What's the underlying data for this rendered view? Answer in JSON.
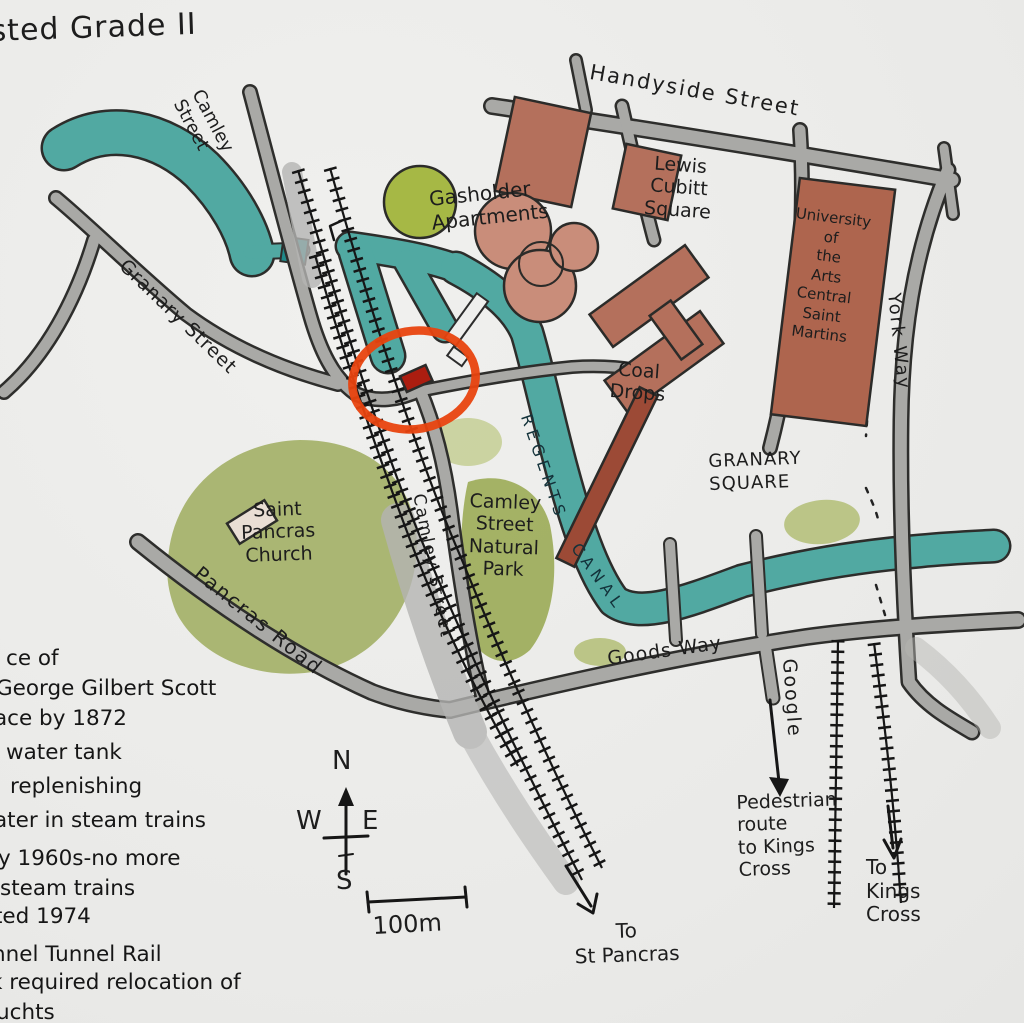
{
  "title_fragment": "sted Grade II",
  "map": {
    "labels": {
      "camley_street_north": "Camley\nStreet",
      "granary_street": "Granary Street",
      "handyside_street": "Handyside Street",
      "lewis_cubitt_square": "Lewis\nCubitt\nSquare",
      "university": "University\nof\nthe\nArts\nCentral\nSaint\nMartins",
      "york_way": "York Way",
      "gasholder_apartments": "Gasholder\nApartments",
      "coal_drops": "Coal\nDrops",
      "granary_square": "GRANARY\nSQUARE",
      "regents_canal_word1": "REGENTS",
      "regents_canal_word2": "CANAL",
      "camley_street_south": "Camley Street",
      "camley_park": "Camley\nStreet\nNatural\nPark",
      "saint_pancras_church": "Saint\nPancras\nChurch",
      "pancras_road": "Pancras Road",
      "goods_way": "Goods Way",
      "google": "Google",
      "pedestrian_route": "Pedestrian\nroute\nto Kings\nCross",
      "to_kings_cross": "To\nKings\nCross",
      "to_st_pancras": "To\nSt Pancras"
    },
    "compass": {
      "n": "N",
      "w": "W",
      "e": "E",
      "s": "S"
    },
    "scale": "100m"
  },
  "notes": [
    "ce of",
    "George Gilbert Scott",
    "ace by 1872",
    "water tank",
    "replenishing",
    "ater in steam trains",
    "ly 1960s-no more",
    "steam trains",
    "ted 1974",
    "nnel Tunnel Rail",
    "k required relocation of",
    "uchts"
  ],
  "colors": {
    "paper": "#ebebe9",
    "road": "#a9a9a6",
    "canal": "#51a9a2",
    "park": "#a0ae60",
    "building": "#b4705c",
    "building_dark": "#9c4a36",
    "gasholder": "#c98d7a",
    "tree": "#a6b845",
    "ink": "#1c1c1c",
    "highlight_circle": "#e8430f",
    "highlighted_building": "#ab1d10"
  }
}
